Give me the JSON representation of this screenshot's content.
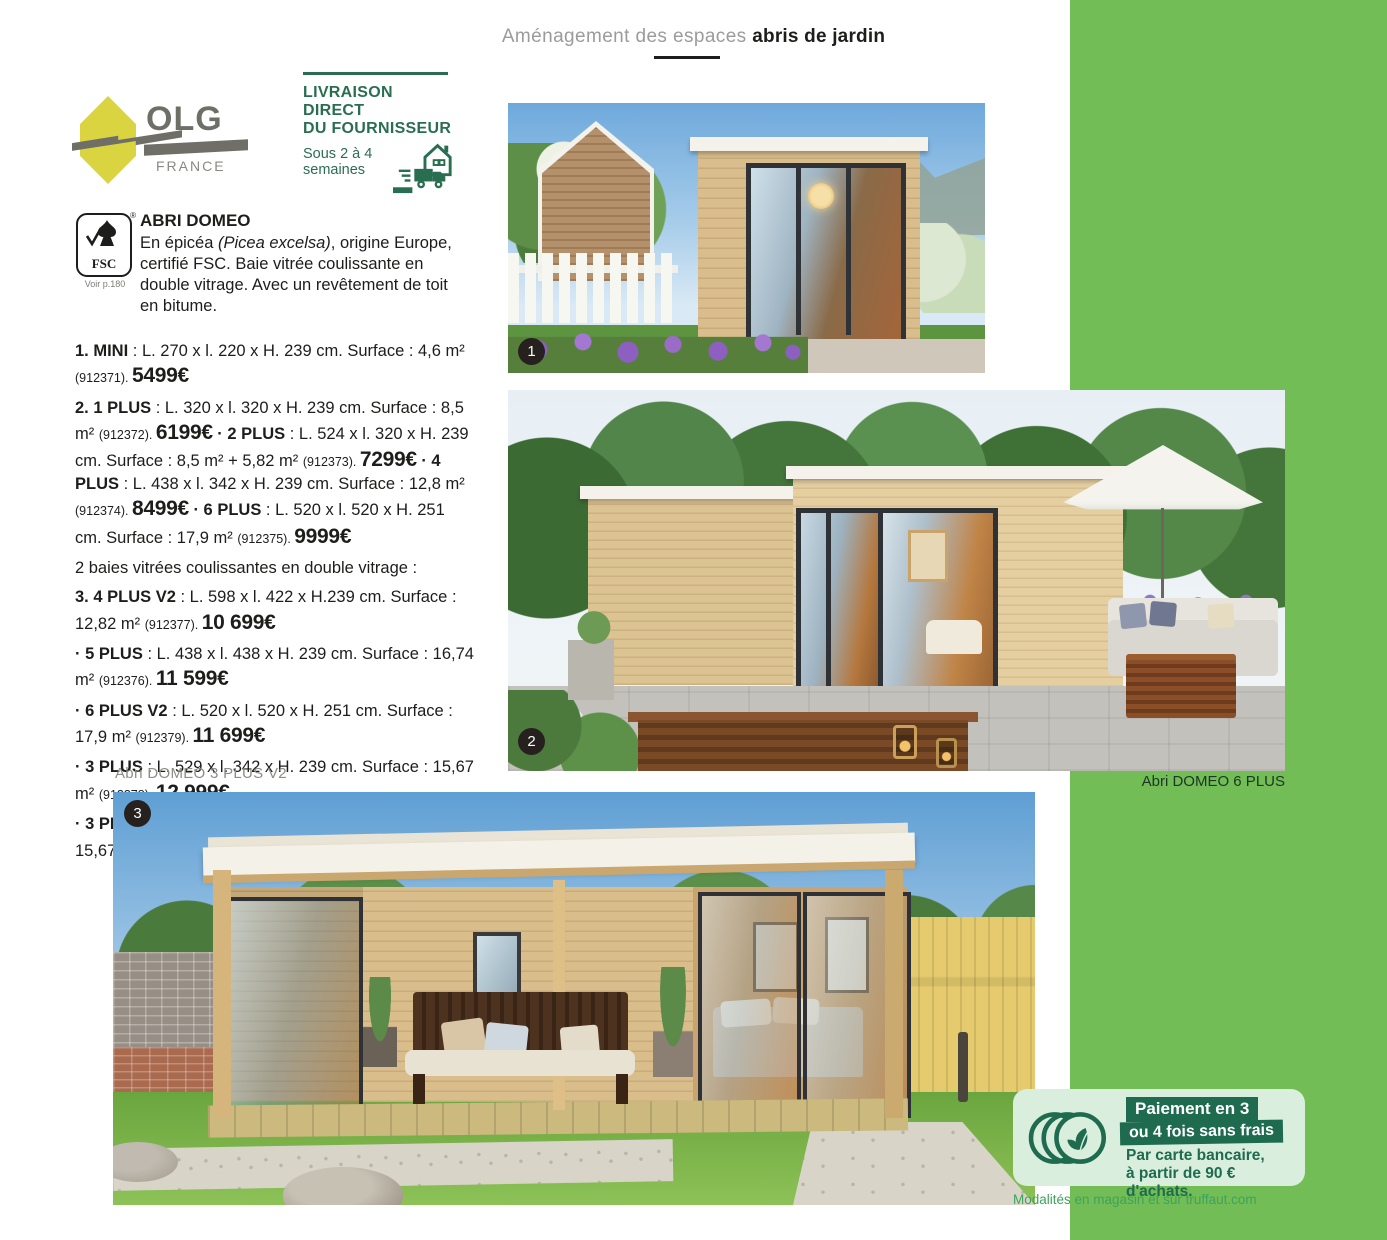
{
  "header": {
    "breadcrumb_light": "Aménagement des espaces ",
    "breadcrumb_bold": "abris de jardin"
  },
  "logos": {
    "olg": {
      "name": "OLG",
      "country": "FRANCE"
    },
    "fsc": {
      "label": "FSC",
      "reg": "®",
      "note": "Voir p.180"
    }
  },
  "delivery": {
    "title_line1": "LIVRAISON DIRECT",
    "title_line2": "DU FOURNISSEUR",
    "delay_line1": "Sous 2 à 4",
    "delay_line2": "semaines"
  },
  "product": {
    "title": "ABRI DOMEO",
    "description": [
      {
        "t": "En épicéa ",
        "s": "n"
      },
      {
        "t": "(Picea excelsa)",
        "s": "i"
      },
      {
        "t": ", origine Europe, certifié FSC. Baie vitrée coulissante en double vitrage. Avec un revêtement de toit en bitume.",
        "s": "n"
      }
    ],
    "listing": [
      {
        "rich": [
          {
            "t": "1. MINI",
            "s": "b"
          },
          {
            "t": " : L. 270 x l. 220 x H. 239 cm. Surface : 4,6 m² ",
            "s": "n"
          },
          {
            "t": "(912371). ",
            "s": "sm"
          },
          {
            "t": "5499€",
            "s": "pr"
          }
        ]
      },
      {
        "rich": [
          {
            "t": "2. 1 PLUS",
            "s": "b"
          },
          {
            "t": " : L. 320 x l. 320 x H. 239 cm. Surface : 8,5 m² ",
            "s": "n"
          },
          {
            "t": "(912372). ",
            "s": "sm"
          },
          {
            "t": "6199€",
            "s": "pr"
          },
          {
            "t": " · 2 PLUS",
            "s": "b"
          },
          {
            "t": " : L. 524 x l. 320 x H. 239 cm. Surface : 8,5 m² + 5,82 m² ",
            "s": "n"
          },
          {
            "t": "(912373). ",
            "s": "sm"
          },
          {
            "t": "7299€",
            "s": "pr"
          },
          {
            "t": " · 4 PLUS",
            "s": "b"
          },
          {
            "t": " : L. 438 x l. 342 x H. 239 cm. Surface : 12,8 m² ",
            "s": "n"
          },
          {
            "t": "(912374). ",
            "s": "sm"
          },
          {
            "t": "8499€",
            "s": "pr"
          },
          {
            "t": " · 6 PLUS",
            "s": "b"
          },
          {
            "t": " : L. 520 x l. 520 x H. 251 cm. Surface : 17,9 m² ",
            "s": "n"
          },
          {
            "t": "(912375). ",
            "s": "sm"
          },
          {
            "t": "9999€",
            "s": "pr"
          }
        ]
      },
      {
        "rich": [
          {
            "t": "2 baies vitrées coulissantes en double vitrage :",
            "s": "n"
          }
        ]
      },
      {
        "rich": [
          {
            "t": "3. 4 PLUS V2",
            "s": "b"
          },
          {
            "t": " : L. 598 x l. 422 x H.239 cm. Surface : 12,82 m² ",
            "s": "n"
          },
          {
            "t": "(912377). ",
            "s": "sm"
          },
          {
            "t": "10 699€",
            "s": "pr"
          }
        ]
      },
      {
        "rich": [
          {
            "t": "· 5 PLUS",
            "s": "b"
          },
          {
            "t": " : L. 438 x l. 438 x H. 239 cm. Surface : 16,74 m² ",
            "s": "n"
          },
          {
            "t": "(912376). ",
            "s": "sm"
          },
          {
            "t": "11 599€",
            "s": "pr"
          }
        ]
      },
      {
        "rich": [
          {
            "t": "· 6 PLUS V2",
            "s": "b"
          },
          {
            "t": " : L. 520 x l. 520 x H. 251 cm. Surface : 17,9 m² ",
            "s": "n"
          },
          {
            "t": "(912379). ",
            "s": "sm"
          },
          {
            "t": "11 699€",
            "s": "pr"
          }
        ]
      },
      {
        "rich": [
          {
            "t": "· 3 PLUS",
            "s": "b"
          },
          {
            "t": " : L. 529 x l. 342 x H. 239 cm. Surface : 15,67 m² ",
            "s": "n"
          },
          {
            "t": "(912378). ",
            "s": "sm"
          },
          {
            "t": "12 999€",
            "s": "pr"
          }
        ]
      },
      {
        "rich": [
          {
            "t": "· 3 PLUS V2",
            "s": "b"
          },
          {
            "t": " : L. 609 x l. 422 x H. 239 cm. Surface : 15,67 m² ",
            "s": "n"
          },
          {
            "t": "(912380). ",
            "s": "sm"
          },
          {
            "t": "13 499€",
            "s": "pr"
          }
        ]
      }
    ]
  },
  "badges": {
    "photo1": "1",
    "photo2": "2",
    "photo3": "3"
  },
  "captions": {
    "photo2": "Abri DOMEO 6 PLUS",
    "photo3": "Abri DOMEO 3 PLUS V2"
  },
  "payment": {
    "band1": "Paiement en 3",
    "band2": "ou 4 fois sans frais",
    "line1": "Par carte bancaire,",
    "line2": "à partir de 90 € d'achats.",
    "note": "Modalités en magasin et sur truffaut.com"
  },
  "colors": {
    "sidebar_green": "#72bd55",
    "brand_dark_green": "#2a6e52",
    "payment_dark_green": "#1e6b50",
    "payment_light_green": "#d9eedd",
    "note_green": "#3ea35c"
  }
}
